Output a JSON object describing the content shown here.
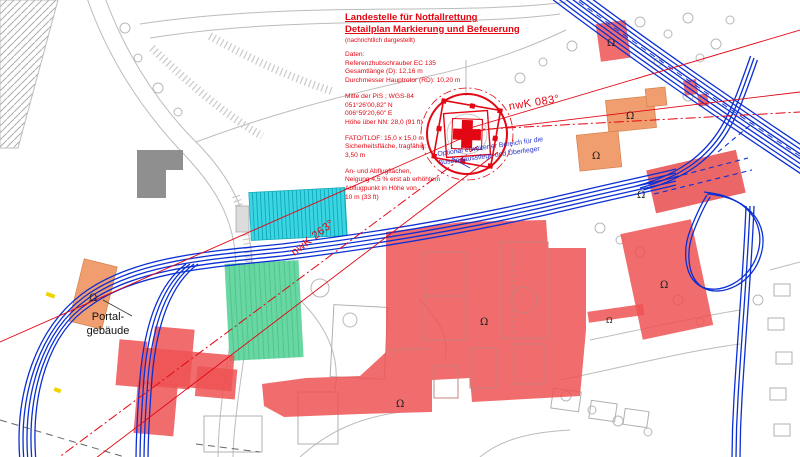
{
  "info_block": {
    "title1": "Landestelle für Notfallrettung",
    "title2": "Detailplan Markierung und Befeuerung",
    "subtitle": "(nachrichtlich dargestellt)",
    "groups": [
      {
        "lines": [
          "Daten:",
          "Referenzhubschrauber EC 135",
          "Gesamtlänge (D): 12,16 m",
          "Durchmesser Hauptrotor (RD): 10,20 m"
        ]
      },
      {
        "lines": [
          "Mitte der PIS ; WGS-84",
          "051°26'00,82\" N",
          "006°59'20,60\" E",
          "Höhe über NN: 28,0 (91 ft)"
        ]
      },
      {
        "lines": [
          "FATO/TLOF: 15,0 x 15,0 m",
          "Sicherheitsfläche, tragfähig:",
          "3,50 m"
        ]
      },
      {
        "lines": [
          "An- und Abflugflächen,",
          "Neigung 4,5 % erst ab erhöhtem",
          "Abflugpunkt in Höhe von",
          "10 m (33 ft)"
        ]
      }
    ]
  },
  "labels": {
    "bearing_east": "nwK 083°",
    "bearing_west": "nwK 263°",
    "portal_line1": "Portal-",
    "portal_line2": "gebäude",
    "blue_note_line1": "Optional erweiterter Bereich für die",
    "blue_note_line2": "Busein-/ausstiege und Überlieger"
  },
  "symbols": {
    "building_marker": "Ω"
  },
  "colors": {
    "marking_red": "#e30613",
    "building_red": "#ee5253",
    "building_orange": "#f09e6f",
    "area_cyan": "#3bd6e3",
    "area_green": "#5cd49a",
    "road_blue": "#0b2fd4",
    "note_blue": "#2433cb",
    "base_gray": "#bcbcbc"
  }
}
